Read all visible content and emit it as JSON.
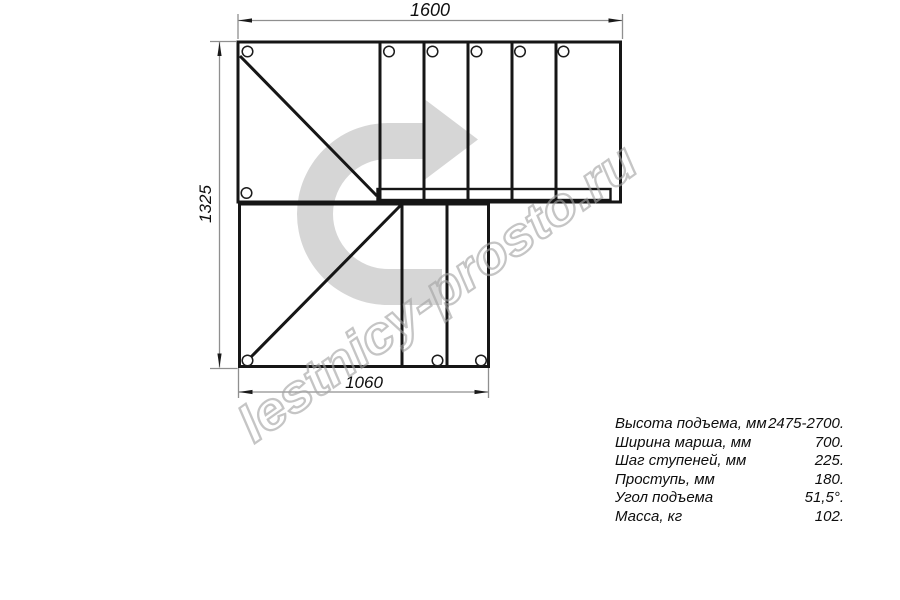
{
  "drawing": {
    "title_dimensions": {
      "top": "1600",
      "left": "1325",
      "bottom": "1060"
    },
    "watermark": {
      "text": "lestnicy-prosto.ru",
      "arrow_color": "#d6d6d6",
      "text_stroke_color": "#a3a3a3"
    },
    "colors": {
      "outline": "#161616",
      "dimension_lines": "#8f8f8f",
      "background": "#ffffff"
    }
  },
  "specs": {
    "rows": [
      {
        "label": "Высота подъема, мм",
        "value": "2475-2700."
      },
      {
        "label": "Ширина марша, мм",
        "value": "700."
      },
      {
        "label": "Шаг ступеней, мм",
        "value": "225."
      },
      {
        "label": "Проступь, мм",
        "value": "180."
      },
      {
        "label": "Угол подъема",
        "value": "51,5°."
      },
      {
        "label": "Масса, кг",
        "value": "102."
      }
    ]
  }
}
